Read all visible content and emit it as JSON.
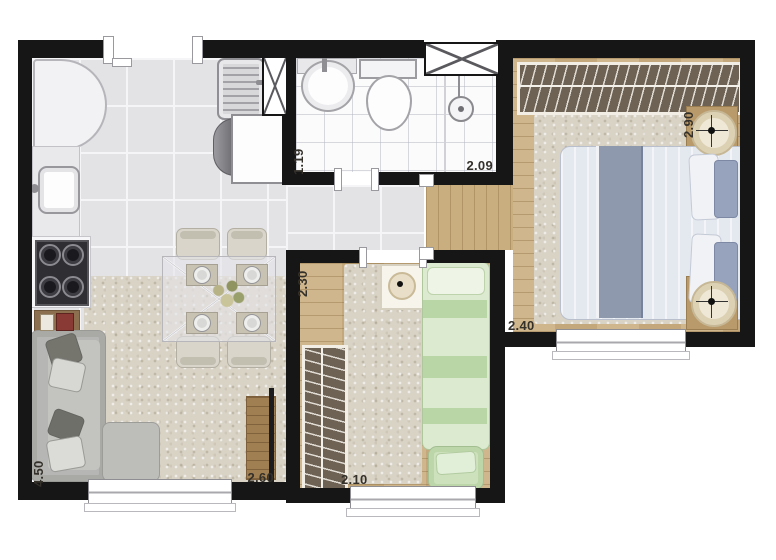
{
  "floorplan": {
    "rooms": {
      "living_kitchen": {
        "height_label": "4.50",
        "width_label": "2.60"
      },
      "bathroom": {
        "height_label": "1.19",
        "width_label": "2.09"
      },
      "master_bedroom": {
        "height_label": "2.90",
        "width_label": "2.40"
      },
      "second_bedroom": {
        "height_label": "2.30",
        "width_label": "2.10"
      }
    },
    "colors": {
      "wall": "#161616",
      "tile_floor": "#e3e3e6",
      "wood_floor": "#ccb184",
      "rug": "#d9d3c6",
      "wardrobe": "#6e6254",
      "master_bed_blanket": "#8e99ae",
      "single_bed": "#cfe4bf",
      "sofa": "#b6b6b4",
      "bathroom_floor": "#fbfbfc"
    },
    "furniture_icons": {
      "refrigerator": "rounded-rect",
      "kitchen-sink": "rounded-rect-basin",
      "stove": "four-burner-grid",
      "laundry-tank": "ridged-basin",
      "washing-machine": "square-with-drum",
      "ventilation-shaft": "x-hatched-box",
      "pedestal-sink": "circle-basin",
      "toilet": "tank-and-bowl",
      "shower": "circle-head",
      "sofa": "l-shape",
      "dining-table": "glass-square-x",
      "tv-rack": "wood-strip",
      "wardrobe": "hanger-hatch-strip",
      "double-bed": "mattress-with-band",
      "single-bed": "green-mattress",
      "nightstand": "circle-on-square",
      "window": "triple-line-band"
    }
  }
}
